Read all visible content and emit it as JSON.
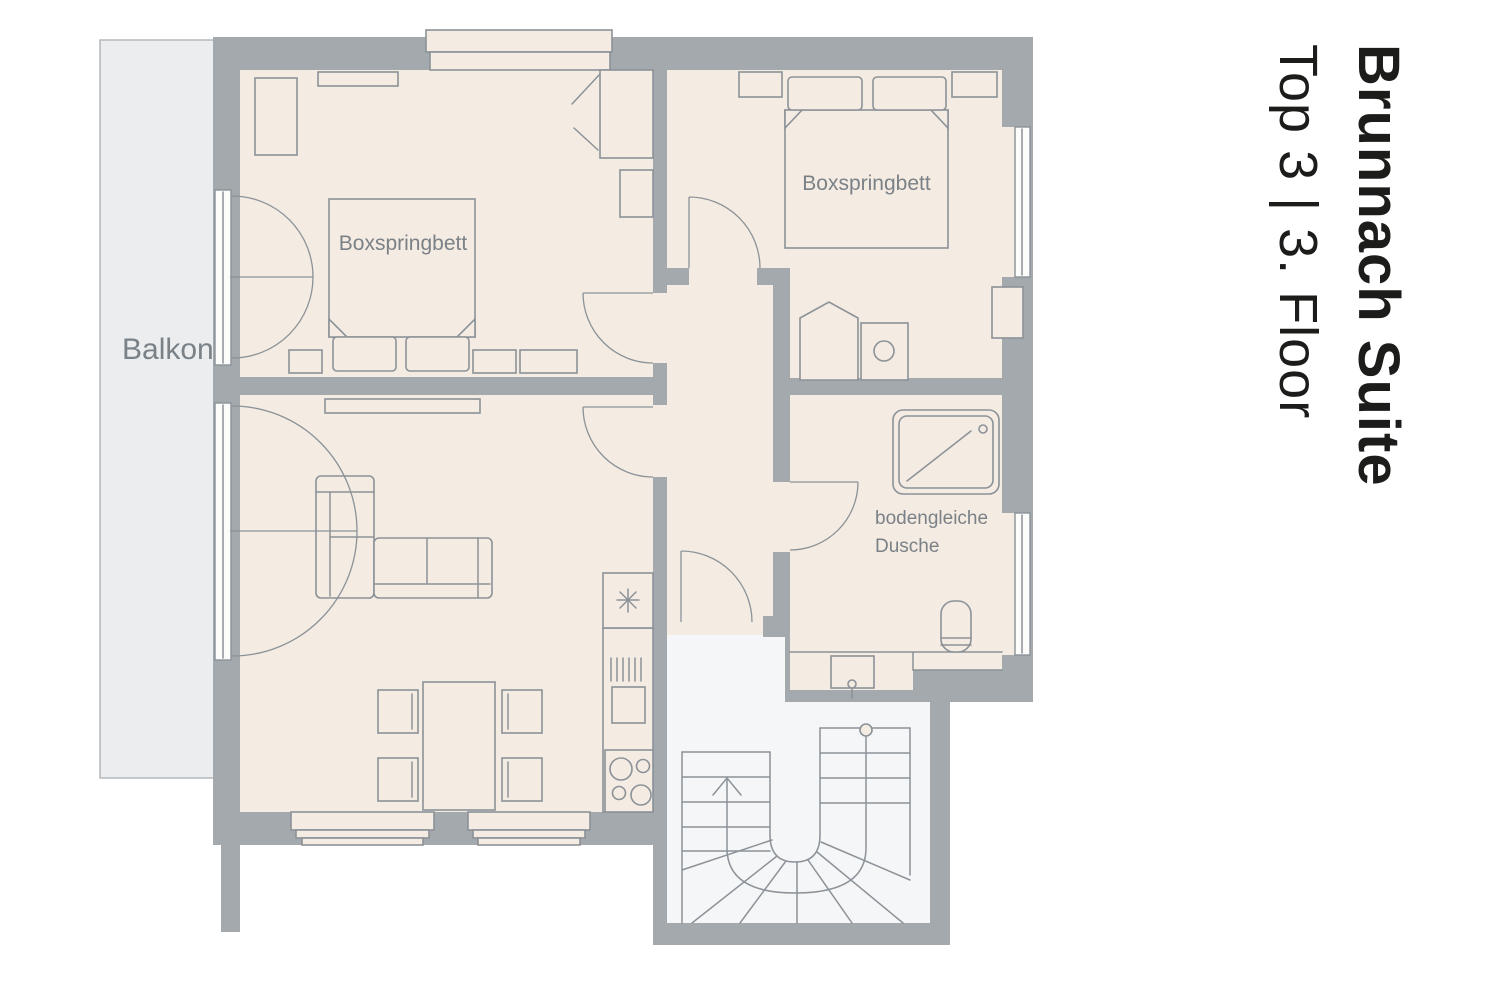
{
  "title": {
    "name": "Brunnach Suite",
    "floor": "Top 3 | 3. Floor"
  },
  "labels": {
    "balcony": "Balkon",
    "bedroom1_bed": "Boxspringbett",
    "bedroom2_bed": "Boxspringbett",
    "shower": "bodengleiche\nDusche"
  },
  "icons": {
    "freezer": "snowflake-asterisk",
    "stair_direction": "up-arrow"
  },
  "colors": {
    "c-wall": "#a3a9ad",
    "c-floor": "#f4ebe2",
    "c-balcony": "#ebedee",
    "c-stairs": "#f5f6f7",
    "c-line": "#8b9298",
    "c-label": "#7a8187",
    "c-title": "#1c1c1a"
  }
}
